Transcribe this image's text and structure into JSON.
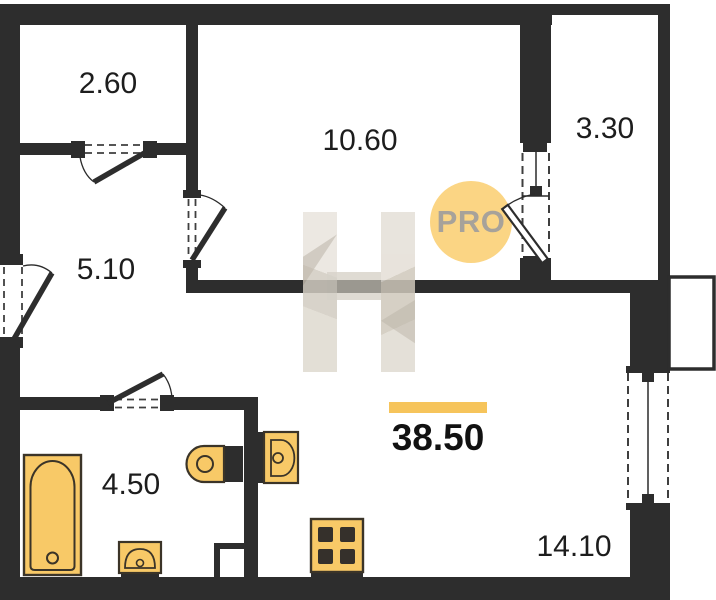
{
  "plan": {
    "rooms": [
      {
        "area": "2.60"
      },
      {
        "area": "10.60"
      },
      {
        "area": "3.30"
      },
      {
        "area": "5.10"
      },
      {
        "area": "4.50"
      },
      {
        "area": "14.10"
      }
    ],
    "total_area": "38.50",
    "badge": {
      "label": "PRO"
    },
    "watermark": {
      "letter": "H"
    },
    "colors": {
      "wall": "#2d2d2d",
      "fixture_fill": "#f8c967",
      "fixture_stroke": "#3b3428",
      "highlight_bar": "#f6c45b",
      "badge_background": "#fbd584",
      "badge_text": "#a7a29a"
    }
  }
}
